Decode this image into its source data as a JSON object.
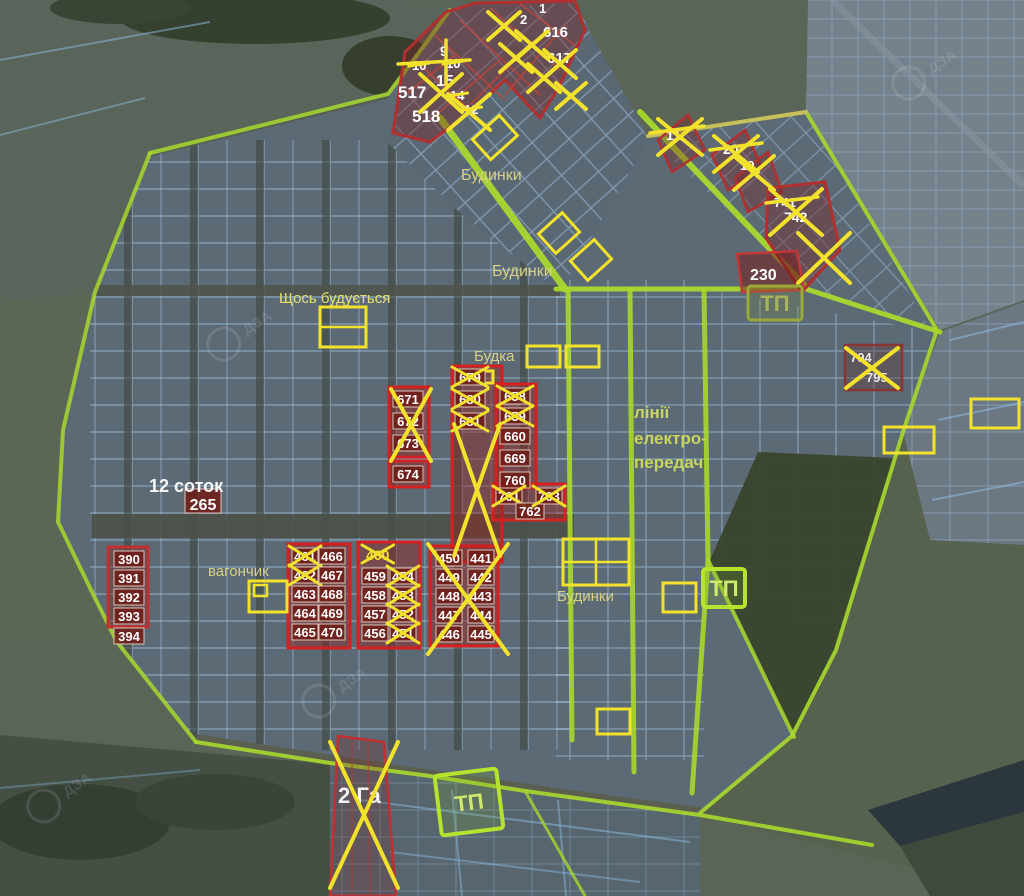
{
  "map_labels": [
    {
      "t": "Будинки",
      "x": 461,
      "y": 180,
      "fs": 16,
      "c": "#d8d184"
    },
    {
      "t": "Будинки",
      "x": 492,
      "y": 276,
      "fs": 16,
      "c": "#d8d184"
    },
    {
      "t": "Щось будується",
      "x": 279,
      "y": 303,
      "fs": 15,
      "c": "#e6e070"
    },
    {
      "t": "Будка",
      "x": 474,
      "y": 361,
      "fs": 15,
      "c": "#d8d184"
    },
    {
      "t": "лінії",
      "x": 634,
      "y": 418,
      "fs": 17,
      "c": "#c9d55f",
      "b": true
    },
    {
      "t": "електро-",
      "x": 634,
      "y": 444,
      "fs": 17,
      "c": "#c9d55f",
      "b": true
    },
    {
      "t": "передач",
      "x": 634,
      "y": 468,
      "fs": 17,
      "c": "#c9d55f",
      "b": true
    },
    {
      "t": "12 соток",
      "x": 149,
      "y": 492,
      "fs": 18,
      "c": "#f8f8f8",
      "b": true
    },
    {
      "t": "вагончик",
      "x": 208,
      "y": 576,
      "fs": 15,
      "c": "#d8d184"
    },
    {
      "t": "Будинки",
      "x": 557,
      "y": 601,
      "fs": 15,
      "c": "#d8d184"
    },
    {
      "t": "2 Га",
      "x": 338,
      "y": 803,
      "fs": 22,
      "c": "#f2f2f2",
      "b": true
    }
  ],
  "plot_chips": [
    {
      "n": "265",
      "x": 185,
      "y": 489,
      "w": 36,
      "h": 24,
      "fs": 16
    },
    {
      "n": "671",
      "x": 393,
      "y": 391
    },
    {
      "n": "672",
      "x": 393,
      "y": 413
    },
    {
      "n": "673",
      "x": 393,
      "y": 435
    },
    {
      "n": "674",
      "x": 393,
      "y": 466
    },
    {
      "n": "679",
      "x": 455,
      "y": 369,
      "cr": true
    },
    {
      "n": "680",
      "x": 455,
      "y": 391,
      "cr": true
    },
    {
      "n": "681",
      "x": 455,
      "y": 413,
      "cr": true
    },
    {
      "n": "658",
      "x": 500,
      "y": 388,
      "cr": true
    },
    {
      "n": "659",
      "x": 500,
      "y": 408,
      "cr": true
    },
    {
      "n": "660",
      "x": 500,
      "y": 428
    },
    {
      "n": "669",
      "x": 500,
      "y": 450
    },
    {
      "n": "760",
      "x": 500,
      "y": 472
    },
    {
      "n": "761",
      "x": 496,
      "y": 488,
      "w": 26,
      "cr": true
    },
    {
      "n": "762",
      "x": 516,
      "y": 503,
      "w": 28
    },
    {
      "n": "763",
      "x": 536,
      "y": 488,
      "w": 26,
      "cr": true
    },
    {
      "n": "390",
      "x": 114,
      "y": 551
    },
    {
      "n": "391",
      "x": 114,
      "y": 570
    },
    {
      "n": "392",
      "x": 114,
      "y": 589
    },
    {
      "n": "393",
      "x": 114,
      "y": 608
    },
    {
      "n": "394",
      "x": 114,
      "y": 628
    },
    {
      "n": "461",
      "x": 292,
      "y": 548,
      "w": 26,
      "cr": true
    },
    {
      "n": "462",
      "x": 292,
      "y": 567,
      "w": 26,
      "cr": true
    },
    {
      "n": "463",
      "x": 292,
      "y": 586,
      "w": 26
    },
    {
      "n": "464",
      "x": 292,
      "y": 605,
      "w": 26
    },
    {
      "n": "465",
      "x": 292,
      "y": 624,
      "w": 26
    },
    {
      "n": "466",
      "x": 319,
      "y": 548,
      "w": 26
    },
    {
      "n": "467",
      "x": 319,
      "y": 567,
      "w": 26
    },
    {
      "n": "468",
      "x": 319,
      "y": 586,
      "w": 26
    },
    {
      "n": "469",
      "x": 319,
      "y": 605,
      "w": 26
    },
    {
      "n": "470",
      "x": 319,
      "y": 624,
      "w": 26
    },
    {
      "n": "459",
      "x": 362,
      "y": 568,
      "w": 26
    },
    {
      "n": "458",
      "x": 362,
      "y": 587,
      "w": 26
    },
    {
      "n": "457",
      "x": 362,
      "y": 606,
      "w": 26
    },
    {
      "n": "456",
      "x": 362,
      "y": 625,
      "w": 26
    },
    {
      "n": "454",
      "x": 390,
      "y": 568,
      "w": 26,
      "cr": true
    },
    {
      "n": "453",
      "x": 390,
      "y": 587,
      "w": 26,
      "cr": true
    },
    {
      "n": "452",
      "x": 390,
      "y": 606,
      "w": 26,
      "cr": true
    },
    {
      "n": "451",
      "x": 390,
      "y": 625,
      "w": 26,
      "cr": true
    },
    {
      "n": "450",
      "x": 436,
      "y": 550,
      "w": 26
    },
    {
      "n": "449",
      "x": 436,
      "y": 569,
      "w": 26
    },
    {
      "n": "448",
      "x": 436,
      "y": 588,
      "w": 26
    },
    {
      "n": "447",
      "x": 436,
      "y": 607,
      "w": 26
    },
    {
      "n": "446",
      "x": 436,
      "y": 626,
      "w": 26
    },
    {
      "n": "441",
      "x": 468,
      "y": 550,
      "w": 26
    },
    {
      "n": "442",
      "x": 468,
      "y": 569,
      "w": 26
    },
    {
      "n": "443",
      "x": 468,
      "y": 588,
      "w": 26
    },
    {
      "n": "444",
      "x": 468,
      "y": 607,
      "w": 26
    },
    {
      "n": "445",
      "x": 468,
      "y": 626,
      "w": 26
    }
  ],
  "plot_texts": [
    {
      "n": "517",
      "x": 398,
      "y": 98,
      "fs": 17,
      "b": true
    },
    {
      "n": "518",
      "x": 412,
      "y": 122,
      "fs": 17,
      "b": true
    },
    {
      "n": "9",
      "x": 440,
      "y": 56,
      "fs": 14,
      "b": true
    },
    {
      "n": "10",
      "x": 412,
      "y": 70,
      "fs": 13,
      "b": true,
      "m": "s"
    },
    {
      "n": "10",
      "x": 446,
      "y": 68,
      "fs": 13,
      "b": true,
      "m": "s"
    },
    {
      "n": "15",
      "x": 436,
      "y": 86,
      "fs": 16,
      "b": true
    },
    {
      "n": "14",
      "x": 450,
      "y": 100,
      "fs": 13,
      "b": true,
      "m": "s"
    },
    {
      "n": "12",
      "x": 464,
      "y": 114,
      "fs": 13,
      "b": true,
      "m": "s"
    },
    {
      "n": "2",
      "x": 520,
      "y": 24,
      "fs": 13,
      "b": true
    },
    {
      "n": "1",
      "x": 539,
      "y": 13,
      "fs": 13,
      "b": true
    },
    {
      "n": "616",
      "x": 543,
      "y": 37,
      "fs": 15,
      "b": true
    },
    {
      "n": "617",
      "x": 547,
      "y": 63,
      "fs": 15,
      "b": true
    },
    {
      "n": "11",
      "x": 666,
      "y": 140,
      "fs": 14,
      "b": true
    },
    {
      "n": "20",
      "x": 723,
      "y": 154,
      "fs": 14,
      "b": true
    },
    {
      "n": "19",
      "x": 740,
      "y": 170,
      "fs": 13,
      "b": true
    },
    {
      "n": "741",
      "x": 774,
      "y": 207,
      "fs": 13,
      "b": true
    },
    {
      "n": "742",
      "x": 784,
      "y": 222,
      "fs": 14,
      "b": true
    },
    {
      "n": "230",
      "x": 750,
      "y": 280,
      "fs": 16,
      "b": true
    },
    {
      "n": "794",
      "x": 850,
      "y": 362,
      "fs": 13,
      "b": true,
      "c": "#e8e8e8"
    },
    {
      "n": "795",
      "x": 866,
      "y": 382,
      "fs": 13,
      "b": true,
      "c": "#e8e8e8"
    },
    {
      "n": "460",
      "x": 366,
      "y": 560,
      "fs": 14,
      "b": true,
      "c": "#f0e02a",
      "m": "x"
    }
  ],
  "x_marks": [
    {
      "x": 420,
      "y": 74,
      "w": 42,
      "h": 38
    },
    {
      "x": 448,
      "y": 94,
      "w": 42,
      "h": 36
    },
    {
      "x": 488,
      "y": 12,
      "w": 32,
      "h": 28
    },
    {
      "x": 516,
      "y": 31,
      "w": 32,
      "h": 28
    },
    {
      "x": 544,
      "y": 50,
      "w": 32,
      "h": 28
    },
    {
      "x": 500,
      "y": 44,
      "w": 32,
      "h": 28
    },
    {
      "x": 528,
      "y": 64,
      "w": 32,
      "h": 28
    },
    {
      "x": 556,
      "y": 83,
      "w": 30,
      "h": 26
    },
    {
      "x": 658,
      "y": 119,
      "w": 44,
      "h": 36
    },
    {
      "x": 714,
      "y": 136,
      "w": 44,
      "h": 36
    },
    {
      "x": 734,
      "y": 156,
      "w": 40,
      "h": 34
    },
    {
      "x": 770,
      "y": 189,
      "w": 52,
      "h": 46
    },
    {
      "x": 798,
      "y": 233,
      "w": 52,
      "h": 50
    },
    {
      "x": 846,
      "y": 348,
      "w": 52,
      "h": 40
    },
    {
      "x": 391,
      "y": 389,
      "w": 40,
      "h": 72
    },
    {
      "x": 454,
      "y": 424,
      "w": 46,
      "h": 132
    },
    {
      "x": 428,
      "y": 544,
      "w": 80,
      "h": 110
    },
    {
      "x": 330,
      "y": 742,
      "w": 68,
      "h": 146
    }
  ],
  "strikes": [
    {
      "x1": 398,
      "y1": 64,
      "x2": 470,
      "y2": 60
    },
    {
      "x1": 446,
      "y1": 40,
      "x2": 446,
      "y2": 84
    },
    {
      "x1": 650,
      "y1": 133,
      "x2": 704,
      "y2": 126
    },
    {
      "x1": 710,
      "y1": 150,
      "x2": 762,
      "y2": 143
    },
    {
      "x1": 766,
      "y1": 203,
      "x2": 818,
      "y2": 197
    }
  ],
  "yellow_boxes": [
    {
      "x": 320,
      "y": 307,
      "w": 46,
      "h": 40,
      "mid": "h"
    },
    {
      "x": 477,
      "y": 371,
      "w": 16,
      "h": 12
    },
    {
      "x": 527,
      "y": 346,
      "w": 33,
      "h": 21
    },
    {
      "x": 566,
      "y": 346,
      "w": 33,
      "h": 21
    },
    {
      "x": 884,
      "y": 427,
      "w": 50,
      "h": 26
    },
    {
      "x": 971,
      "y": 399,
      "w": 48,
      "h": 29
    },
    {
      "x": 249,
      "y": 581,
      "w": 38,
      "h": 31,
      "inner": true
    },
    {
      "x": 563,
      "y": 539,
      "w": 66,
      "h": 46,
      "mid": "hv"
    },
    {
      "x": 663,
      "y": 583,
      "w": 33,
      "h": 29
    },
    {
      "x": 597,
      "y": 709,
      "w": 33,
      "h": 25
    },
    {
      "x": 477,
      "y": 124,
      "w": 36,
      "h": 27,
      "rot": -42
    },
    {
      "x": 543,
      "y": 220,
      "w": 32,
      "h": 26,
      "rot": -42
    },
    {
      "x": 575,
      "y": 247,
      "w": 32,
      "h": 26,
      "rot": -42
    }
  ],
  "tp_boxes": [
    {
      "t": "ТП",
      "x": 748,
      "y": 286,
      "w": 54,
      "h": 34,
      "bright": false
    },
    {
      "t": "ТП",
      "x": 703,
      "y": 569,
      "w": 42,
      "h": 38,
      "bright": true
    },
    {
      "t": "ТП",
      "x": 438,
      "y": 772,
      "w": 62,
      "h": 60,
      "bright": true,
      "rot": -7
    }
  ],
  "watermarks": [
    {
      "t": "ДЗА",
      "x": 250,
      "y": 333
    },
    {
      "t": "ДЗА",
      "x": 345,
      "y": 690
    },
    {
      "t": "ДЗА",
      "x": 70,
      "y": 795
    },
    {
      "t": "ДЗА",
      "x": 935,
      "y": 72
    }
  ],
  "colors": {
    "lime": "#a8d82e",
    "yellow": "#f2e22c",
    "red": "#cc2a20",
    "chip_bg": "#701c16",
    "grid_blue": "#a8cdf0",
    "khaki": "#d8d184"
  }
}
